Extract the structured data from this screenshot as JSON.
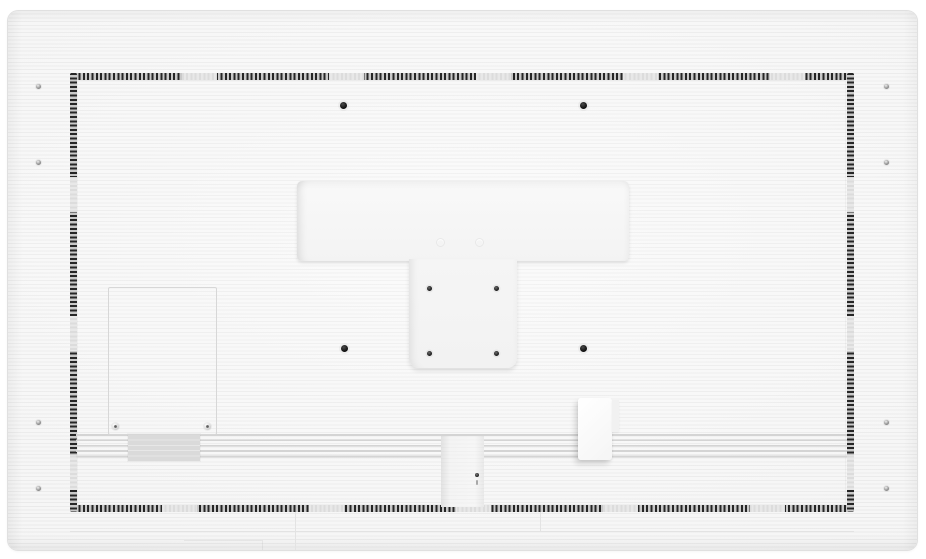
{
  "scene": {
    "type": "product-photograph",
    "subject": "rear-view-of-white-flat-panel-display",
    "orientation": "landscape",
    "visible_text": []
  },
  "colors": {
    "background": "#ffffff",
    "panel_base": "#f7f7f7",
    "ridge_line": "#e9e9e9",
    "vent_dash_dark": "#262626",
    "vent_base_gray": "#c9c9c9",
    "band_ridge": "#d4d4d4",
    "label_gray": "#dadada",
    "hole_black": "#0e0e0e",
    "seam_gray": "#e3e3e3"
  },
  "parts": {
    "back_panel": "ridged white rear housing",
    "vent_border": "perforated vent strips forming inner rectangle",
    "mount_recess": "T-shaped smooth mount plate, centre top",
    "vesa_holes_large_count": 4,
    "vesa_holes_small_count": 4,
    "edge_screws_count": 8,
    "service_panel": "outlined access panel, lower left, 2 screws",
    "rating_label": "grey label patch on vent band",
    "vent_band": "horizontal ribbed vent band near bottom",
    "cable_channel": "recessed vertical channel, bottom centre, 1 screw",
    "power_cover": "raised white cover, bottom right of channel"
  }
}
